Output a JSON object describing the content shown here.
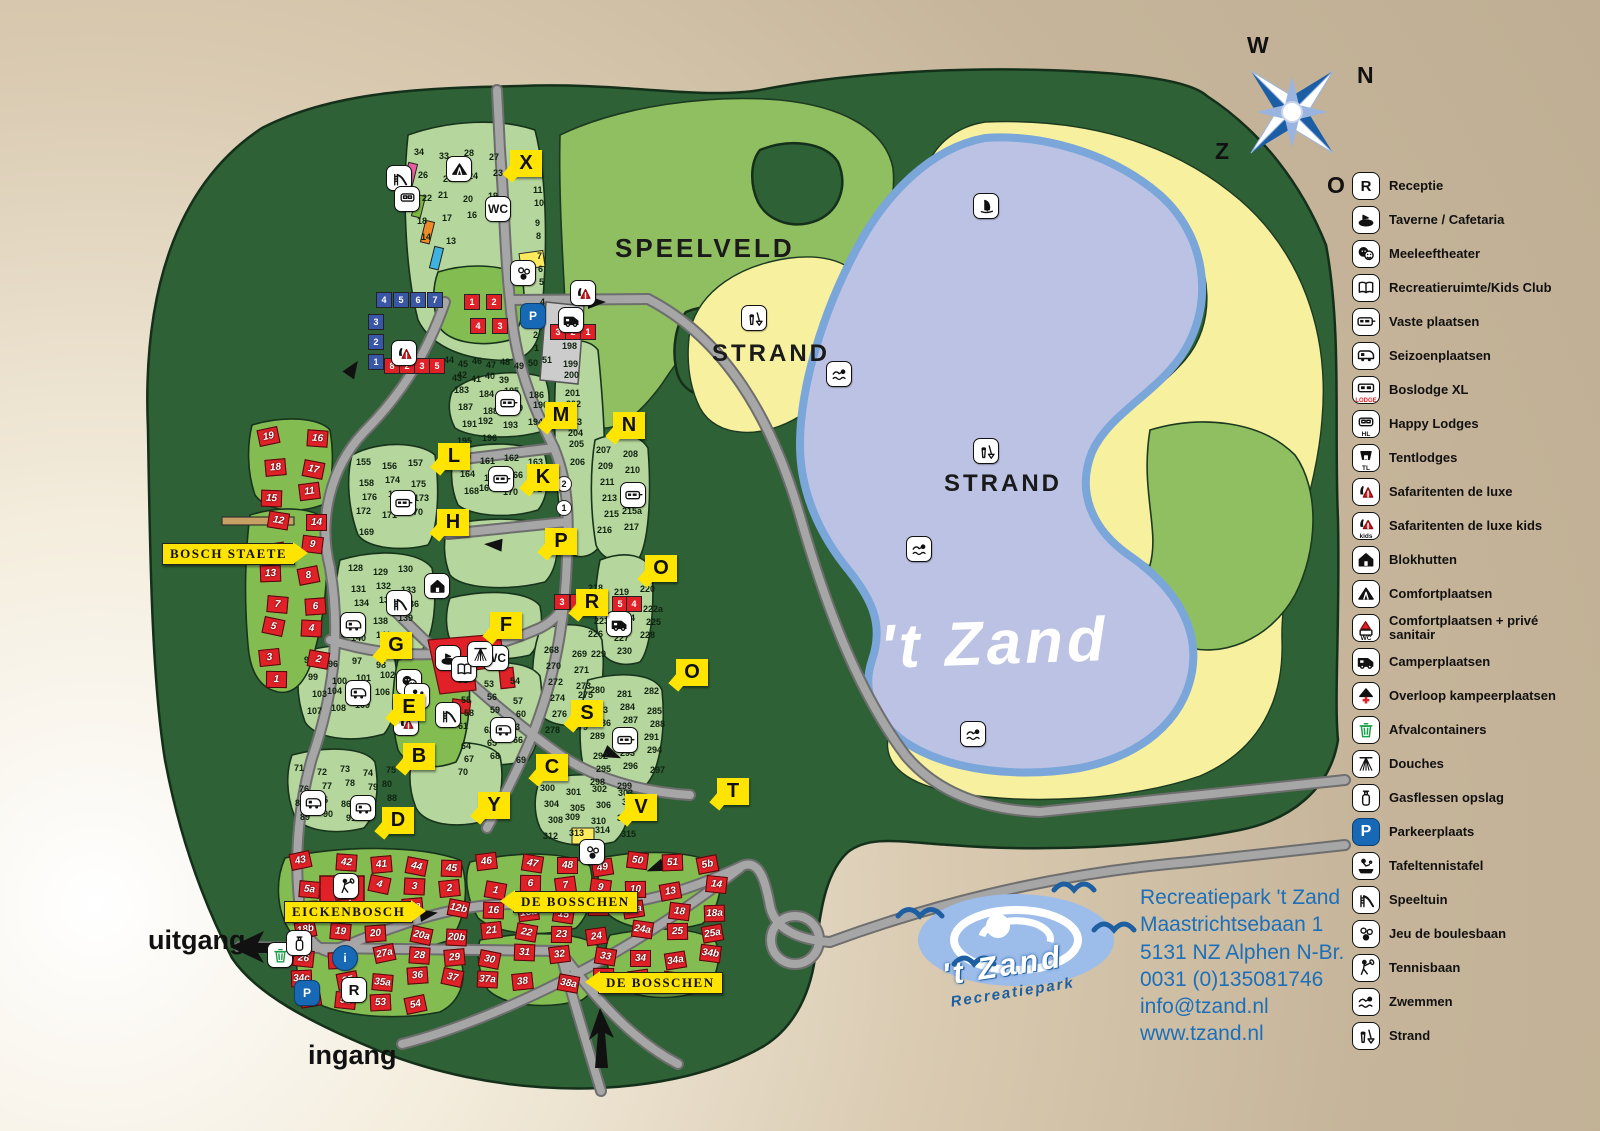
{
  "page_title": "Plattegrond Recreatiepark 't Zand",
  "colors": {
    "forest": "#2e6135",
    "field": "#b5d69c",
    "bright_field": "#83bd52",
    "meadow": "#90bf62",
    "lake": "#bcc2e3",
    "lake_edge": "#7aa6d9",
    "beach": "#f7f09f",
    "road": "#a6a6a6",
    "marker": "#ffe400",
    "accent_blue": "#1c6fb8",
    "logo_blue": "#1d5fa0",
    "red": "#e02128"
  },
  "compass": {
    "west": "W",
    "north": "N",
    "south": "Z",
    "east": "O"
  },
  "lake": {
    "name": "'t Zand"
  },
  "area_labels": [
    {
      "id": "speelveld",
      "text": "SPEELVELD",
      "x": 615,
      "y": 233,
      "size": 26
    },
    {
      "id": "strand-west",
      "text": "STRAND",
      "x": 712,
      "y": 340,
      "size": 24
    },
    {
      "id": "strand-east",
      "text": "STRAND",
      "x": 944,
      "y": 470,
      "size": 24
    }
  ],
  "signs": [
    {
      "text": "BOSCH STAETE",
      "x": 162,
      "y": 543,
      "arrow": "right"
    },
    {
      "text": "EICKENBOSCH",
      "x": 284,
      "y": 901,
      "arrow": "right"
    },
    {
      "text": "DE BOSSCHEN",
      "x": 513,
      "y": 891,
      "arrow": "left"
    },
    {
      "text": "DE BOSSCHEN",
      "x": 598,
      "y": 972,
      "arrow": "left"
    }
  ],
  "gates": {
    "exit": "uitgang",
    "entrance": "ingang"
  },
  "route_markers": [
    {
      "letter": "X",
      "x": 510,
      "y": 150
    },
    {
      "letter": "M",
      "x": 545,
      "y": 402
    },
    {
      "letter": "N",
      "x": 613,
      "y": 412
    },
    {
      "letter": "L",
      "x": 438,
      "y": 443
    },
    {
      "letter": "K",
      "x": 527,
      "y": 464
    },
    {
      "letter": "H",
      "x": 437,
      "y": 509
    },
    {
      "letter": "P",
      "x": 545,
      "y": 528
    },
    {
      "letter": "O",
      "x": 645,
      "y": 555
    },
    {
      "letter": "R",
      "x": 576,
      "y": 589
    },
    {
      "letter": "F",
      "x": 490,
      "y": 612
    },
    {
      "letter": "G",
      "x": 380,
      "y": 632
    },
    {
      "letter": "O",
      "x": 676,
      "y": 659
    },
    {
      "letter": "E",
      "x": 393,
      "y": 694
    },
    {
      "letter": "S",
      "x": 571,
      "y": 700
    },
    {
      "letter": "B",
      "x": 403,
      "y": 743
    },
    {
      "letter": "C",
      "x": 536,
      "y": 754
    },
    {
      "letter": "Y",
      "x": 478,
      "y": 792
    },
    {
      "letter": "V",
      "x": 625,
      "y": 794
    },
    {
      "letter": "T",
      "x": 717,
      "y": 778
    },
    {
      "letter": "D",
      "x": 382,
      "y": 807
    }
  ],
  "map_icons": [
    {
      "icon": "zwemmen-icon",
      "x": 826,
      "y": 361
    },
    {
      "icon": "zwemmen-icon",
      "x": 906,
      "y": 536
    },
    {
      "icon": "zwemmen-icon",
      "x": 960,
      "y": 721
    },
    {
      "icon": "windsurf-icon",
      "x": 973,
      "y": 193
    },
    {
      "icon": "strand-icon",
      "x": 741,
      "y": 305
    },
    {
      "icon": "strand-icon",
      "x": 973,
      "y": 438
    },
    {
      "icon": "wc-icon",
      "x": 485,
      "y": 196
    },
    {
      "icon": "wc-icon",
      "x": 483,
      "y": 645
    },
    {
      "icon": "taverne-icon",
      "x": 435,
      "y": 645
    },
    {
      "icon": "kidsclub-icon",
      "x": 451,
      "y": 656
    },
    {
      "icon": "douche-icon",
      "x": 467,
      "y": 641
    },
    {
      "icon": "theater-icon",
      "x": 396,
      "y": 669
    },
    {
      "icon": "tafeltennis-icon",
      "x": 404,
      "y": 683
    },
    {
      "icon": "speeltuin-icon",
      "x": 435,
      "y": 702
    },
    {
      "icon": "speeltuin-icon",
      "x": 386,
      "y": 165
    },
    {
      "icon": "speeltuin-icon",
      "x": 386,
      "y": 590
    },
    {
      "icon": "comfortplaats-icon",
      "x": 446,
      "y": 156
    },
    {
      "icon": "blokhut-icon",
      "x": 424,
      "y": 573
    },
    {
      "icon": "parkeer-icon",
      "x": 520,
      "y": 303
    },
    {
      "icon": "parkeer-icon",
      "x": 294,
      "y": 980
    },
    {
      "icon": "reception-icon",
      "x": 341,
      "y": 977
    },
    {
      "icon": "info-icon",
      "x": 332,
      "y": 945
    },
    {
      "icon": "afvalcontainer-icon",
      "x": 267,
      "y": 942
    },
    {
      "icon": "gasflessen-icon",
      "x": 286,
      "y": 930
    },
    {
      "icon": "tennisbaan-icon",
      "x": 333,
      "y": 873
    },
    {
      "icon": "jeu-de-boules-icon",
      "x": 510,
      "y": 260
    },
    {
      "icon": "jeu-de-boules-icon",
      "x": 579,
      "y": 839
    },
    {
      "icon": "camperplaats-icon",
      "x": 606,
      "y": 611
    },
    {
      "icon": "camperplaats-icon",
      "x": 558,
      "y": 307
    },
    {
      "icon": "safaritent-icon",
      "x": 570,
      "y": 280
    },
    {
      "icon": "safaritent-icon",
      "x": 393,
      "y": 710
    },
    {
      "icon": "safaritent-icon",
      "x": 391,
      "y": 340
    },
    {
      "icon": "vaste-plaatsen-icon",
      "x": 495,
      "y": 390
    },
    {
      "icon": "vaste-plaatsen-icon",
      "x": 488,
      "y": 466
    },
    {
      "icon": "vaste-plaatsen-icon",
      "x": 390,
      "y": 490
    },
    {
      "icon": "vaste-plaatsen-icon",
      "x": 620,
      "y": 482
    },
    {
      "icon": "seizoenplaatsen-icon",
      "x": 340,
      "y": 612
    },
    {
      "icon": "seizoenplaatsen-icon",
      "x": 345,
      "y": 680
    },
    {
      "icon": "seizoenplaatsen-icon",
      "x": 490,
      "y": 717
    },
    {
      "icon": "seizoenplaatsen-icon",
      "x": 300,
      "y": 790
    },
    {
      "icon": "seizoenplaatsen-icon",
      "x": 350,
      "y": 795
    },
    {
      "icon": "vaste-plaatsen-icon",
      "x": 612,
      "y": 727
    },
    {
      "icon": "happy-lodges-icon",
      "x": 394,
      "y": 186
    }
  ],
  "plot_clusters": [
    {
      "name": "camping-noord",
      "x": 418,
      "y": 150,
      "cols": 4,
      "dx": 24,
      "dy": 21,
      "values": [
        "34",
        "33",
        "28",
        "27",
        "26",
        "25",
        "24",
        "23",
        "22",
        "21",
        "20",
        "19",
        "18",
        "17",
        "16",
        "15",
        "14",
        "13"
      ]
    },
    {
      "name": "camping-noord-rij",
      "x": 536,
      "y": 168,
      "cols": 1,
      "dx": 0,
      "dy": 16,
      "values": [
        "12",
        "11",
        "10",
        "9",
        "8",
        "7",
        "6",
        "5",
        "4",
        "3",
        "2",
        "1"
      ]
    },
    {
      "name": "veld-39-51",
      "x": 448,
      "y": 358,
      "cols": 8,
      "dx": 13,
      "dy": 14,
      "values": [
        "44",
        "45",
        "46",
        "47",
        "48",
        "49",
        "50",
        "51",
        "43",
        "42",
        "41",
        "40",
        "39"
      ]
    },
    {
      "name": "veld-183-196",
      "x": 458,
      "y": 388,
      "cols": 4,
      "dx": 24,
      "dy": 15,
      "values": [
        "183",
        "184",
        "185",
        "186",
        "187",
        "188",
        "189",
        "190",
        "191",
        "192",
        "193",
        "194",
        "195",
        "196"
      ]
    },
    {
      "name": "veld-155-177",
      "x": 360,
      "y": 460,
      "cols": 3,
      "dx": 25,
      "dy": 16,
      "values": [
        "155",
        "156",
        "157",
        "158",
        "174",
        "175",
        "176",
        "177",
        "173",
        "172",
        "171",
        "170",
        "169"
      ]
    },
    {
      "name": "veld-160-171",
      "x": 460,
      "y": 455,
      "cols": 4,
      "dx": 23,
      "dy": 15,
      "values": [
        "160",
        "161",
        "162",
        "163",
        "164",
        "165",
        "166",
        "167",
        "168",
        "169",
        "170",
        "171"
      ]
    },
    {
      "name": "veld-198-206",
      "x": 566,
      "y": 344,
      "cols": 1,
      "dx": 0,
      "dy": 14,
      "values": [
        "198",
        "199",
        "200",
        "201",
        "202",
        "203",
        "204",
        "205",
        "206"
      ]
    },
    {
      "name": "veld-207-217",
      "x": 600,
      "y": 448,
      "cols": 2,
      "dx": 26,
      "dy": 15,
      "values": [
        "207",
        "208",
        "209",
        "210",
        "211",
        "212",
        "213",
        "214",
        "215",
        "215a",
        "216",
        "217"
      ]
    },
    {
      "name": "veld-218-230",
      "x": 592,
      "y": 586,
      "cols": 3,
      "dx": 25,
      "dy": 15,
      "values": [
        "218",
        "219",
        "220",
        "221",
        "222",
        "222a",
        "223",
        "224",
        "225",
        "226",
        "227",
        "228",
        "229",
        "230"
      ]
    },
    {
      "name": "veld-128-141",
      "x": 352,
      "y": 566,
      "cols": 3,
      "dx": 24,
      "dy": 16,
      "values": [
        "128",
        "129",
        "130",
        "131",
        "132",
        "133",
        "134",
        "135",
        "136",
        "137",
        "138",
        "139",
        "140",
        "141"
      ]
    },
    {
      "name": "veld-95-109",
      "x": 308,
      "y": 658,
      "cols": 4,
      "dx": 23,
      "dy": 15,
      "values": [
        "95",
        "96",
        "97",
        "98",
        "99",
        "100",
        "101",
        "102",
        "103",
        "104",
        "105",
        "106",
        "107",
        "108",
        "109"
      ]
    },
    {
      "name": "veld-52-70",
      "x": 462,
      "y": 678,
      "cols": 3,
      "dx": 25,
      "dy": 15,
      "values": [
        "52",
        "53",
        "54",
        "55",
        "56",
        "57",
        "58",
        "59",
        "60",
        "61",
        "62",
        "63",
        "64",
        "65",
        "66",
        "67",
        "68",
        "69",
        "70"
      ]
    },
    {
      "name": "veld-71-93",
      "x": 298,
      "y": 766,
      "cols": 5,
      "dx": 22,
      "dy": 15,
      "values": [
        "71",
        "72",
        "73",
        "74",
        "75",
        "76",
        "77",
        "78",
        "79",
        "80",
        "81",
        "85",
        "86",
        "87",
        "88",
        "89",
        "90",
        "91",
        "92",
        "93"
      ]
    },
    {
      "name": "veld-268-279",
      "x": 548,
      "y": 648,
      "cols": 2,
      "dx": 27,
      "dy": 15,
      "values": [
        "268",
        "269",
        "270",
        "271",
        "272",
        "273",
        "274",
        "275",
        "276",
        "277",
        "278",
        "279"
      ]
    },
    {
      "name": "veld-280-299",
      "x": 594,
      "y": 688,
      "cols": 3,
      "dx": 26,
      "dy": 15,
      "values": [
        "280",
        "281",
        "282",
        "283",
        "284",
        "285",
        "286",
        "287",
        "288",
        "289",
        "290",
        "291",
        "292",
        "293",
        "294",
        "295",
        "296",
        "297",
        "298",
        "299"
      ]
    },
    {
      "name": "veld-300-315",
      "x": 544,
      "y": 786,
      "cols": 4,
      "dx": 25,
      "dy": 14,
      "values": [
        "300",
        "301",
        "302",
        "303",
        "304",
        "305",
        "306",
        "307",
        "308",
        "309",
        "310",
        "311",
        "312",
        "313",
        "314",
        "315"
      ]
    }
  ],
  "house_clusters": [
    {
      "name": "bosch-staete-huizen",
      "x": 263,
      "y": 432,
      "cols": 2,
      "dx": 40,
      "dy": 27,
      "values": [
        "19",
        "16",
        "18",
        "17",
        "15",
        "11",
        "12",
        "14",
        "10",
        "9",
        "13",
        "8",
        "7",
        "6",
        "5",
        "4",
        "3",
        "2",
        "1"
      ]
    },
    {
      "name": "de-bosschen-bungalows",
      "x": 295,
      "y": 856,
      "cols": 12,
      "dx": 37,
      "dy": 23,
      "values": [
        "43",
        "42",
        "41",
        "44",
        "45",
        "46",
        "47",
        "48",
        "49",
        "50",
        "51",
        "5b",
        "5a",
        "5",
        "4",
        "3",
        "2",
        "1",
        "6",
        "7",
        "9",
        "10",
        "13",
        "14",
        "11a",
        "11",
        "12",
        "12a",
        "12b",
        "16",
        "16a",
        "15",
        "17",
        "17a",
        "18",
        "18a",
        "18b",
        "19",
        "20",
        "20a",
        "20b",
        "21",
        "22",
        "23",
        "24",
        "24a",
        "25",
        "25a",
        "26",
        "27",
        "27a",
        "28",
        "29",
        "30",
        "31",
        "32",
        "33",
        "34",
        "34a",
        "34b",
        "34c",
        "35",
        "35a",
        "36",
        "37",
        "37a",
        "38",
        "38a",
        "39",
        "39a",
        "40",
        "40b",
        "40c",
        "52",
        "53",
        "54"
      ]
    }
  ],
  "mini_plots": [
    {
      "name": "happy-lodges-rij",
      "color": "blue",
      "x": 376,
      "y": 292,
      "cols": 4,
      "dx": 17,
      "dy": 0,
      "values": [
        "4",
        "5",
        "6",
        "7"
      ]
    },
    {
      "name": "happy-lodges-kolom",
      "color": "blue",
      "x": 368,
      "y": 314,
      "cols": 1,
      "dx": 0,
      "dy": 20,
      "values": [
        "3",
        "2",
        "1"
      ]
    },
    {
      "name": "safari-rij",
      "color": "red",
      "x": 384,
      "y": 358,
      "cols": 4,
      "dx": 15,
      "dy": 0,
      "values": [
        "8",
        "2",
        "3",
        "5"
      ]
    },
    {
      "name": "safari-noord-a",
      "color": "red",
      "x": 464,
      "y": 294,
      "cols": 2,
      "dx": 22,
      "dy": 0,
      "values": [
        "1",
        "2"
      ]
    },
    {
      "name": "safari-noord-b",
      "color": "red",
      "x": 470,
      "y": 318,
      "cols": 2,
      "dx": 22,
      "dy": 0,
      "values": [
        "4",
        "3"
      ]
    },
    {
      "name": "plaats-321-noord",
      "color": "red",
      "x": 550,
      "y": 324,
      "cols": 3,
      "dx": 15,
      "dy": 0,
      "values": [
        "3",
        "2",
        "1"
      ]
    },
    {
      "name": "plaats-321-midden",
      "color": "red",
      "x": 554,
      "y": 594,
      "cols": 3,
      "dx": 16,
      "dy": 0,
      "values": [
        "3",
        "2",
        "1"
      ]
    },
    {
      "name": "plaats-54",
      "color": "red",
      "x": 612,
      "y": 596,
      "cols": 2,
      "dx": 14,
      "dy": 0,
      "values": [
        "5",
        "4"
      ]
    },
    {
      "name": "plaats-rondjes",
      "color": "white",
      "x": 556,
      "y": 476,
      "cols": 1,
      "dx": 0,
      "dy": 24,
      "values": [
        "2",
        "1"
      ]
    }
  ],
  "legend": {
    "items": [
      {
        "icon": "reception-icon",
        "label": "Receptie"
      },
      {
        "icon": "taverne-icon",
        "label": "Taverne / Cafetaria"
      },
      {
        "icon": "theater-icon",
        "label": "Meeleeftheater"
      },
      {
        "icon": "kidsclub-icon",
        "label": "Recreatieruimte/Kids Club"
      },
      {
        "icon": "vaste-plaatsen-icon",
        "label": "Vaste plaatsen"
      },
      {
        "icon": "seizoenplaatsen-icon",
        "label": "Seizoenplaatsen"
      },
      {
        "icon": "boslodge-xl-icon",
        "label": "Boslodge XL",
        "tag": "LODGE"
      },
      {
        "icon": "happy-lodges-icon",
        "label": "Happy Lodges",
        "tag": "HL"
      },
      {
        "icon": "tentlodges-icon",
        "label": "Tentlodges",
        "tag": "TL"
      },
      {
        "icon": "safaritent-icon",
        "label": "Safaritenten de luxe"
      },
      {
        "icon": "safaritent-kids-icon",
        "label": "Safaritenten de luxe kids",
        "tag": "kids"
      },
      {
        "icon": "blokhut-icon",
        "label": "Blokhutten"
      },
      {
        "icon": "comfortplaats-icon",
        "label": "Comfortplaatsen"
      },
      {
        "icon": "comfortplaats-sanitair-icon",
        "label": "Comfortplaatsen + privé sanitair",
        "tag": "WC"
      },
      {
        "icon": "camperplaats-icon",
        "label": "Camperplaatsen"
      },
      {
        "icon": "overloop-icon",
        "label": "Overloop kampeerplaatsen"
      },
      {
        "icon": "afvalcontainer-icon",
        "label": "Afvalcontainers"
      },
      {
        "icon": "douche-icon",
        "label": "Douches"
      },
      {
        "icon": "gasflessen-icon",
        "label": "Gasflessen opslag"
      },
      {
        "icon": "parkeer-icon",
        "label": "Parkeerplaats"
      },
      {
        "icon": "tafeltennis-icon",
        "label": "Tafeltennistafel"
      },
      {
        "icon": "speeltuin-icon",
        "label": "Speeltuin"
      },
      {
        "icon": "jeu-de-boules-icon",
        "label": "Jeu de boulesbaan"
      },
      {
        "icon": "tennisbaan-icon",
        "label": "Tennisbaan"
      },
      {
        "icon": "zwemmen-icon",
        "label": "Zwemmen"
      },
      {
        "icon": "strand-icon",
        "label": "Strand"
      }
    ]
  },
  "logo": {
    "title": "'t Zand",
    "subtitle": "Recreatiepark"
  },
  "contact": {
    "lines": [
      "Recreatiepark 't Zand",
      "Maastrichtsebaan 1",
      "5131 NZ  Alphen N-Br.",
      "0031 (0)135081746",
      "info@tzand.nl",
      "www.tzand.nl"
    ]
  }
}
